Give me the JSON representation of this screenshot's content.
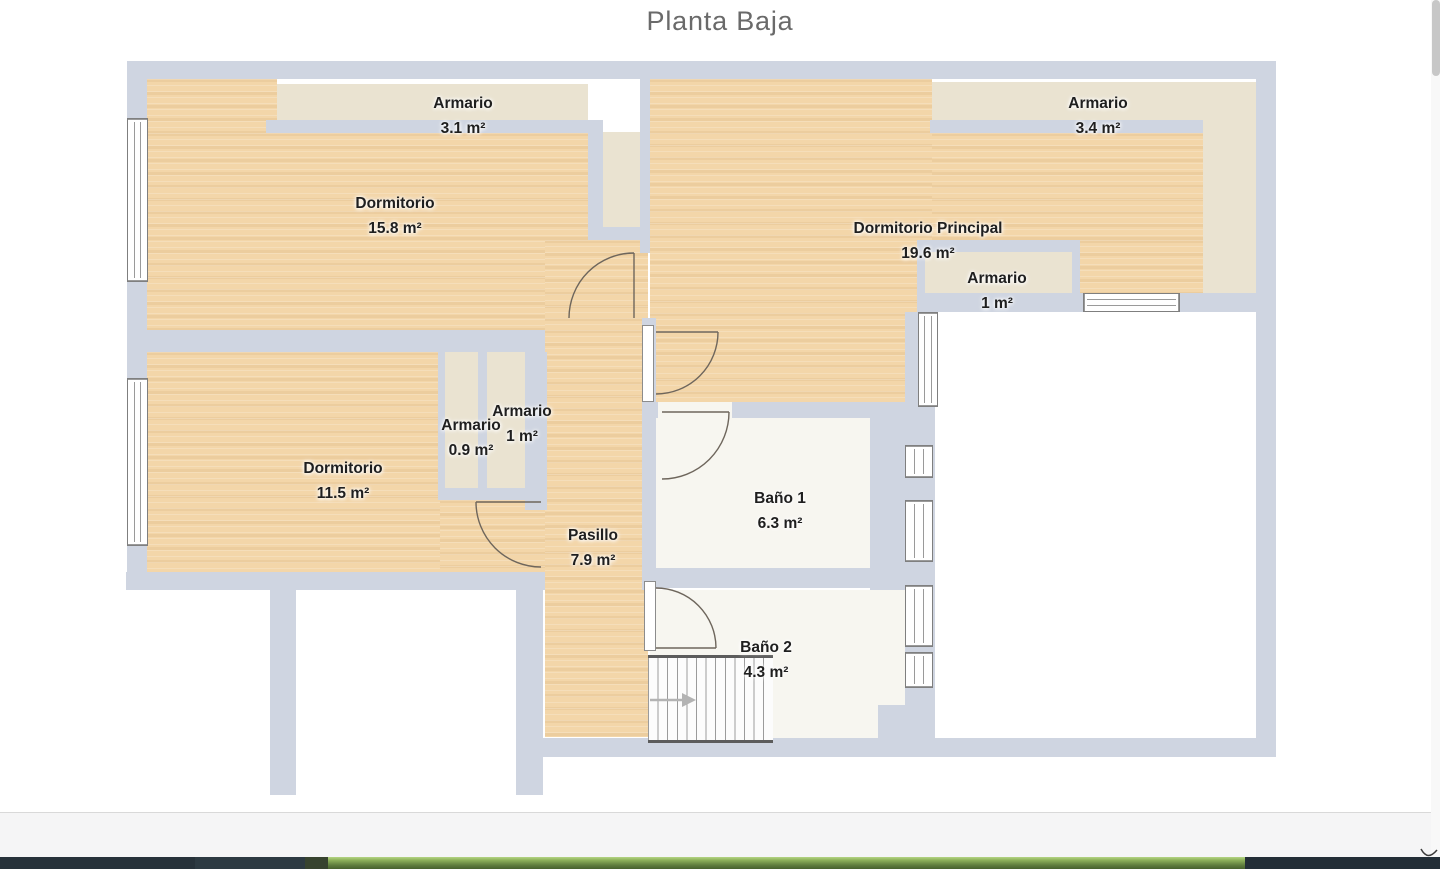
{
  "page": {
    "title": "Planta Baja"
  },
  "rooms": [
    {
      "name": "Dormitorio",
      "area": "15.8 m²"
    },
    {
      "name": "Armario",
      "area": "3.1 m²"
    },
    {
      "name": "Dormitorio Principal",
      "area": "19.6 m²"
    },
    {
      "name": "Armario",
      "area": "3.4 m²"
    },
    {
      "name": "Armario",
      "area": "1 m²"
    },
    {
      "name": "Dormitorio",
      "area": "11.5 m²"
    },
    {
      "name": "Armario",
      "area": "0.9 m²"
    },
    {
      "name": "Armario",
      "area": "1 m²"
    },
    {
      "name": "Pasillo",
      "area": "7.9 m²"
    },
    {
      "name": "Baño 1",
      "area": "6.3 m²"
    },
    {
      "name": "Baño 2",
      "area": "4.3 m²"
    }
  ],
  "colors": {
    "wall": "#cfd5e1",
    "wood_floor": "#f3d6a9",
    "closet": "#eae3d1",
    "bath_floor": "#f7f6f0",
    "footer_bar_dark": "#27323a",
    "footer_bar_green": "#7fa24f"
  }
}
